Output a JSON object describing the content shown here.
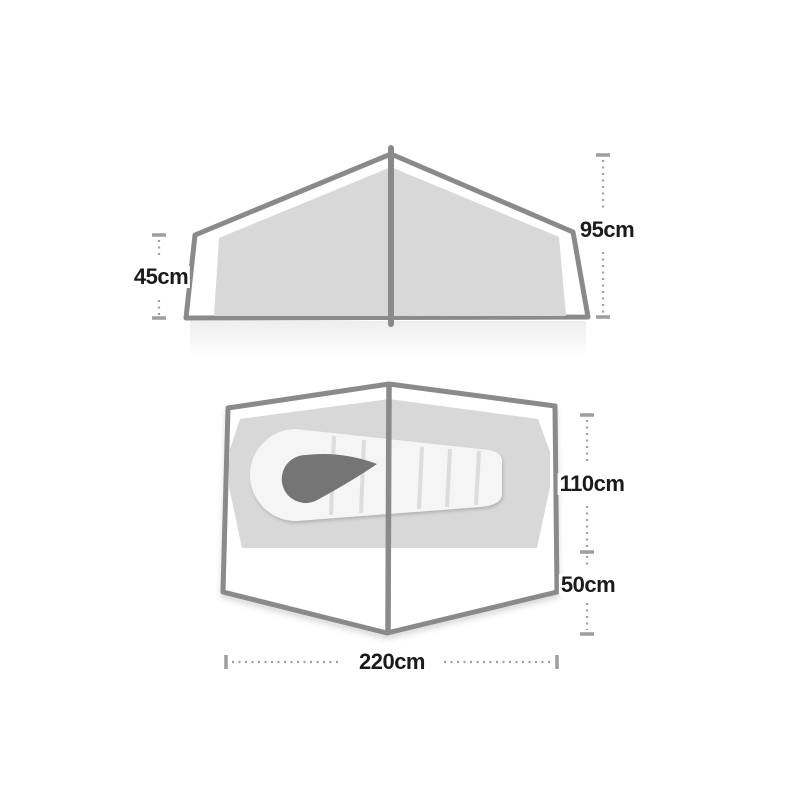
{
  "page": {
    "title": "Tent dimensions diagram",
    "background": "#ffffff"
  },
  "colors": {
    "outline_stroke": "#8a8a8a",
    "panel_fill": "#d8d8d8",
    "tent_fill": "#ffffff",
    "sleeping_bag_fill": "#f5f5f5",
    "sleeping_bag_hood": "#757575",
    "baffle_line": "#dcdcdc",
    "dimension_line": "#9e9e9e",
    "label_text": "#1b1b1b"
  },
  "side_view": {
    "name": "tent side elevation",
    "label_left": "45cm",
    "label_right": "95cm"
  },
  "floor_plan": {
    "name": "tent floor plan with sleeping bag",
    "label_inner_depth": "110cm",
    "label_porch_depth": "50cm",
    "label_width": "220cm"
  }
}
